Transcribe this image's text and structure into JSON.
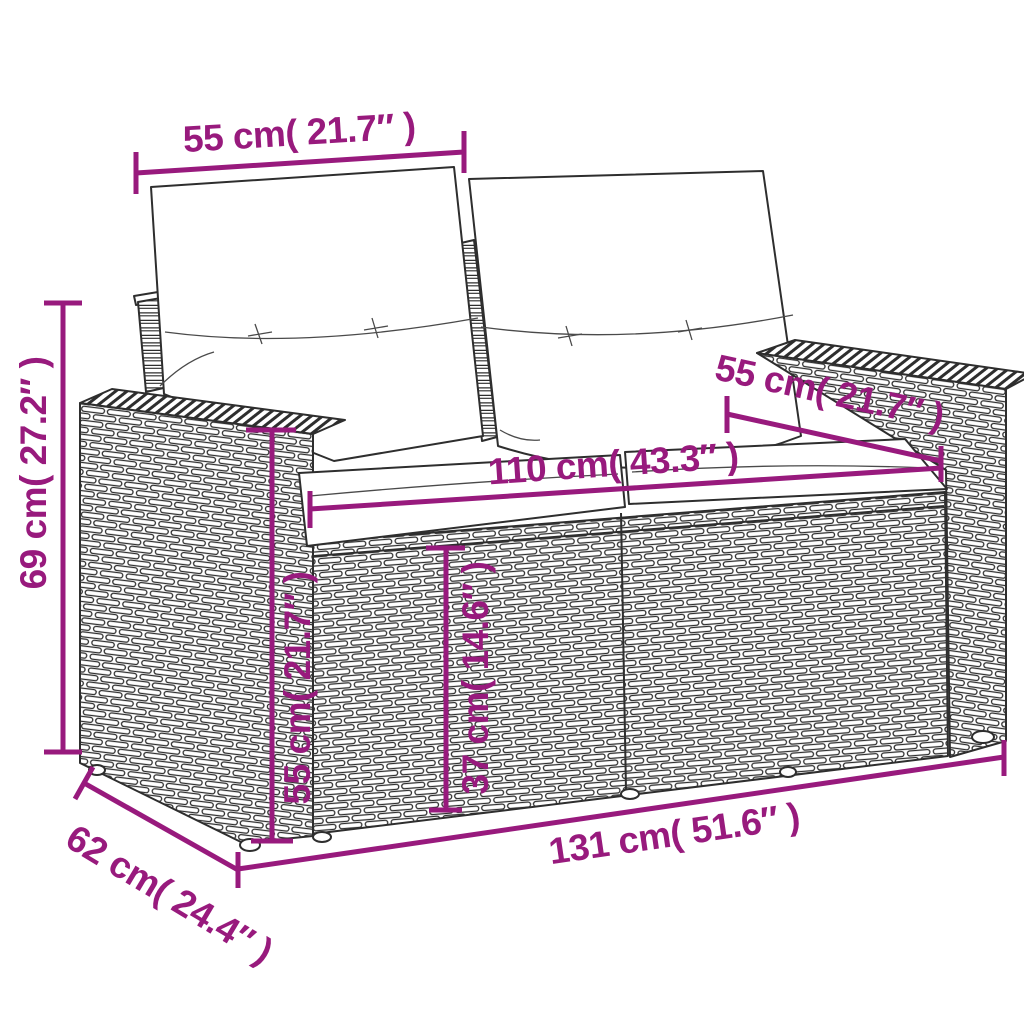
{
  "diagram": {
    "title": "rattan loveseat dimension diagram",
    "accent_color": "#981A7D",
    "outline_color": "#2e2e2e",
    "background_color": "#ffffff",
    "measurements": {
      "backrest_width": "55 cm( 21.7″ )",
      "total_height": "69 cm( 27.2″ )",
      "backrest_width_right": "55 cm( 21.7″ )",
      "seat_width": "110 cm( 43.3″ )",
      "armrest_height": "55 cm( 21.7″ )",
      "seat_height": "37 cm( 14.6″ )",
      "total_width": "131 cm( 51.6″ )",
      "total_depth": "62 cm( 24.4″ )"
    }
  }
}
